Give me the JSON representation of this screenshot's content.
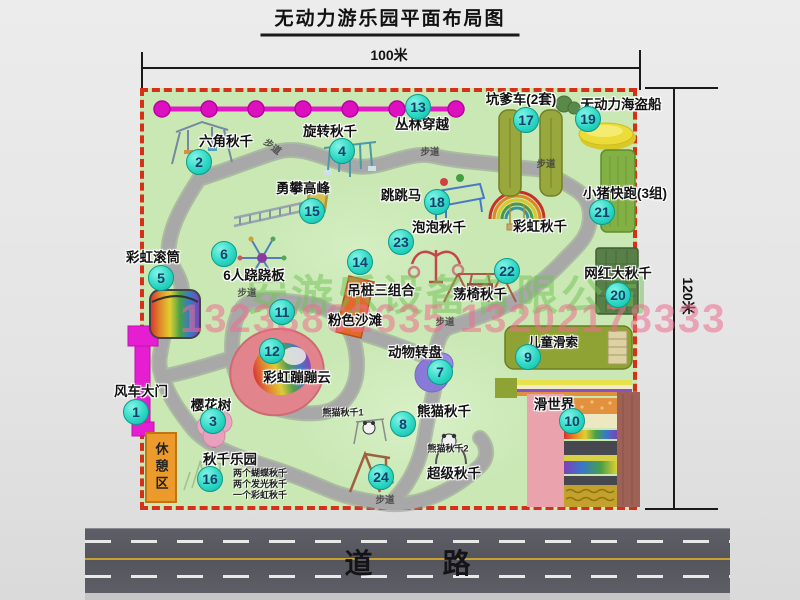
{
  "title": "无动力游乐园平面布局图",
  "dimensions": {
    "width_label": "100米",
    "height_label": "120米"
  },
  "road_label": "道路",
  "path_label": "步道",
  "rest_area_label": "休憩区",
  "rainbow_swing_label": "彩虹秋千",
  "watermark": {
    "company": "安游乐设备有限公司",
    "phone": "13233862635 13202178333"
  },
  "colors": {
    "map_green": "#c9e8b4",
    "border_red": "#d63018",
    "badge_teal": "#2cd8c4",
    "zipline_magenta": "#e418c8",
    "road_gray": "#55555d",
    "rest_orange": "#ec9a2c",
    "watermark_green": "#70c054",
    "watermark_pink": "#ee6c8e"
  },
  "attractions": [
    {
      "num": "1",
      "label": "风车大门"
    },
    {
      "num": "2",
      "label": "六角秋千"
    },
    {
      "num": "3",
      "label": "樱花树"
    },
    {
      "num": "4",
      "label": "旋转秋千"
    },
    {
      "num": "5",
      "label": "彩虹滚筒"
    },
    {
      "num": "6",
      "label": "6人跷跷板"
    },
    {
      "num": "7",
      "label": "动物转盘"
    },
    {
      "num": "8",
      "label": "熊猫秋千",
      "sub1": "熊猫秋千1",
      "sub2": "熊猫秋千2"
    },
    {
      "num": "9",
      "label": "儿童滑索"
    },
    {
      "num": "10",
      "label": "滑世界"
    },
    {
      "num": "11",
      "label": "粉色沙滩"
    },
    {
      "num": "12",
      "label": "彩虹蹦蹦云"
    },
    {
      "num": "13",
      "label": "丛林穿越"
    },
    {
      "num": "14",
      "label": "吊桩三组合"
    },
    {
      "num": "15",
      "label": "勇攀高峰"
    },
    {
      "num": "16",
      "label": "秋千乐园",
      "notes": [
        "两个蝴蝶秋千",
        "两个发光秋千",
        "一个彩虹秋千"
      ]
    },
    {
      "num": "17",
      "label": "坑爹车(2套)"
    },
    {
      "num": "18",
      "label": "跳跳马"
    },
    {
      "num": "19",
      "label": "无动力海盗船"
    },
    {
      "num": "20",
      "label": "网红大秋千"
    },
    {
      "num": "21",
      "label": "小猪快跑(3组)"
    },
    {
      "num": "22",
      "label": "荡椅秋千"
    },
    {
      "num": "23",
      "label": "泡泡秋千"
    },
    {
      "num": "24",
      "label": "超级秋千"
    }
  ]
}
